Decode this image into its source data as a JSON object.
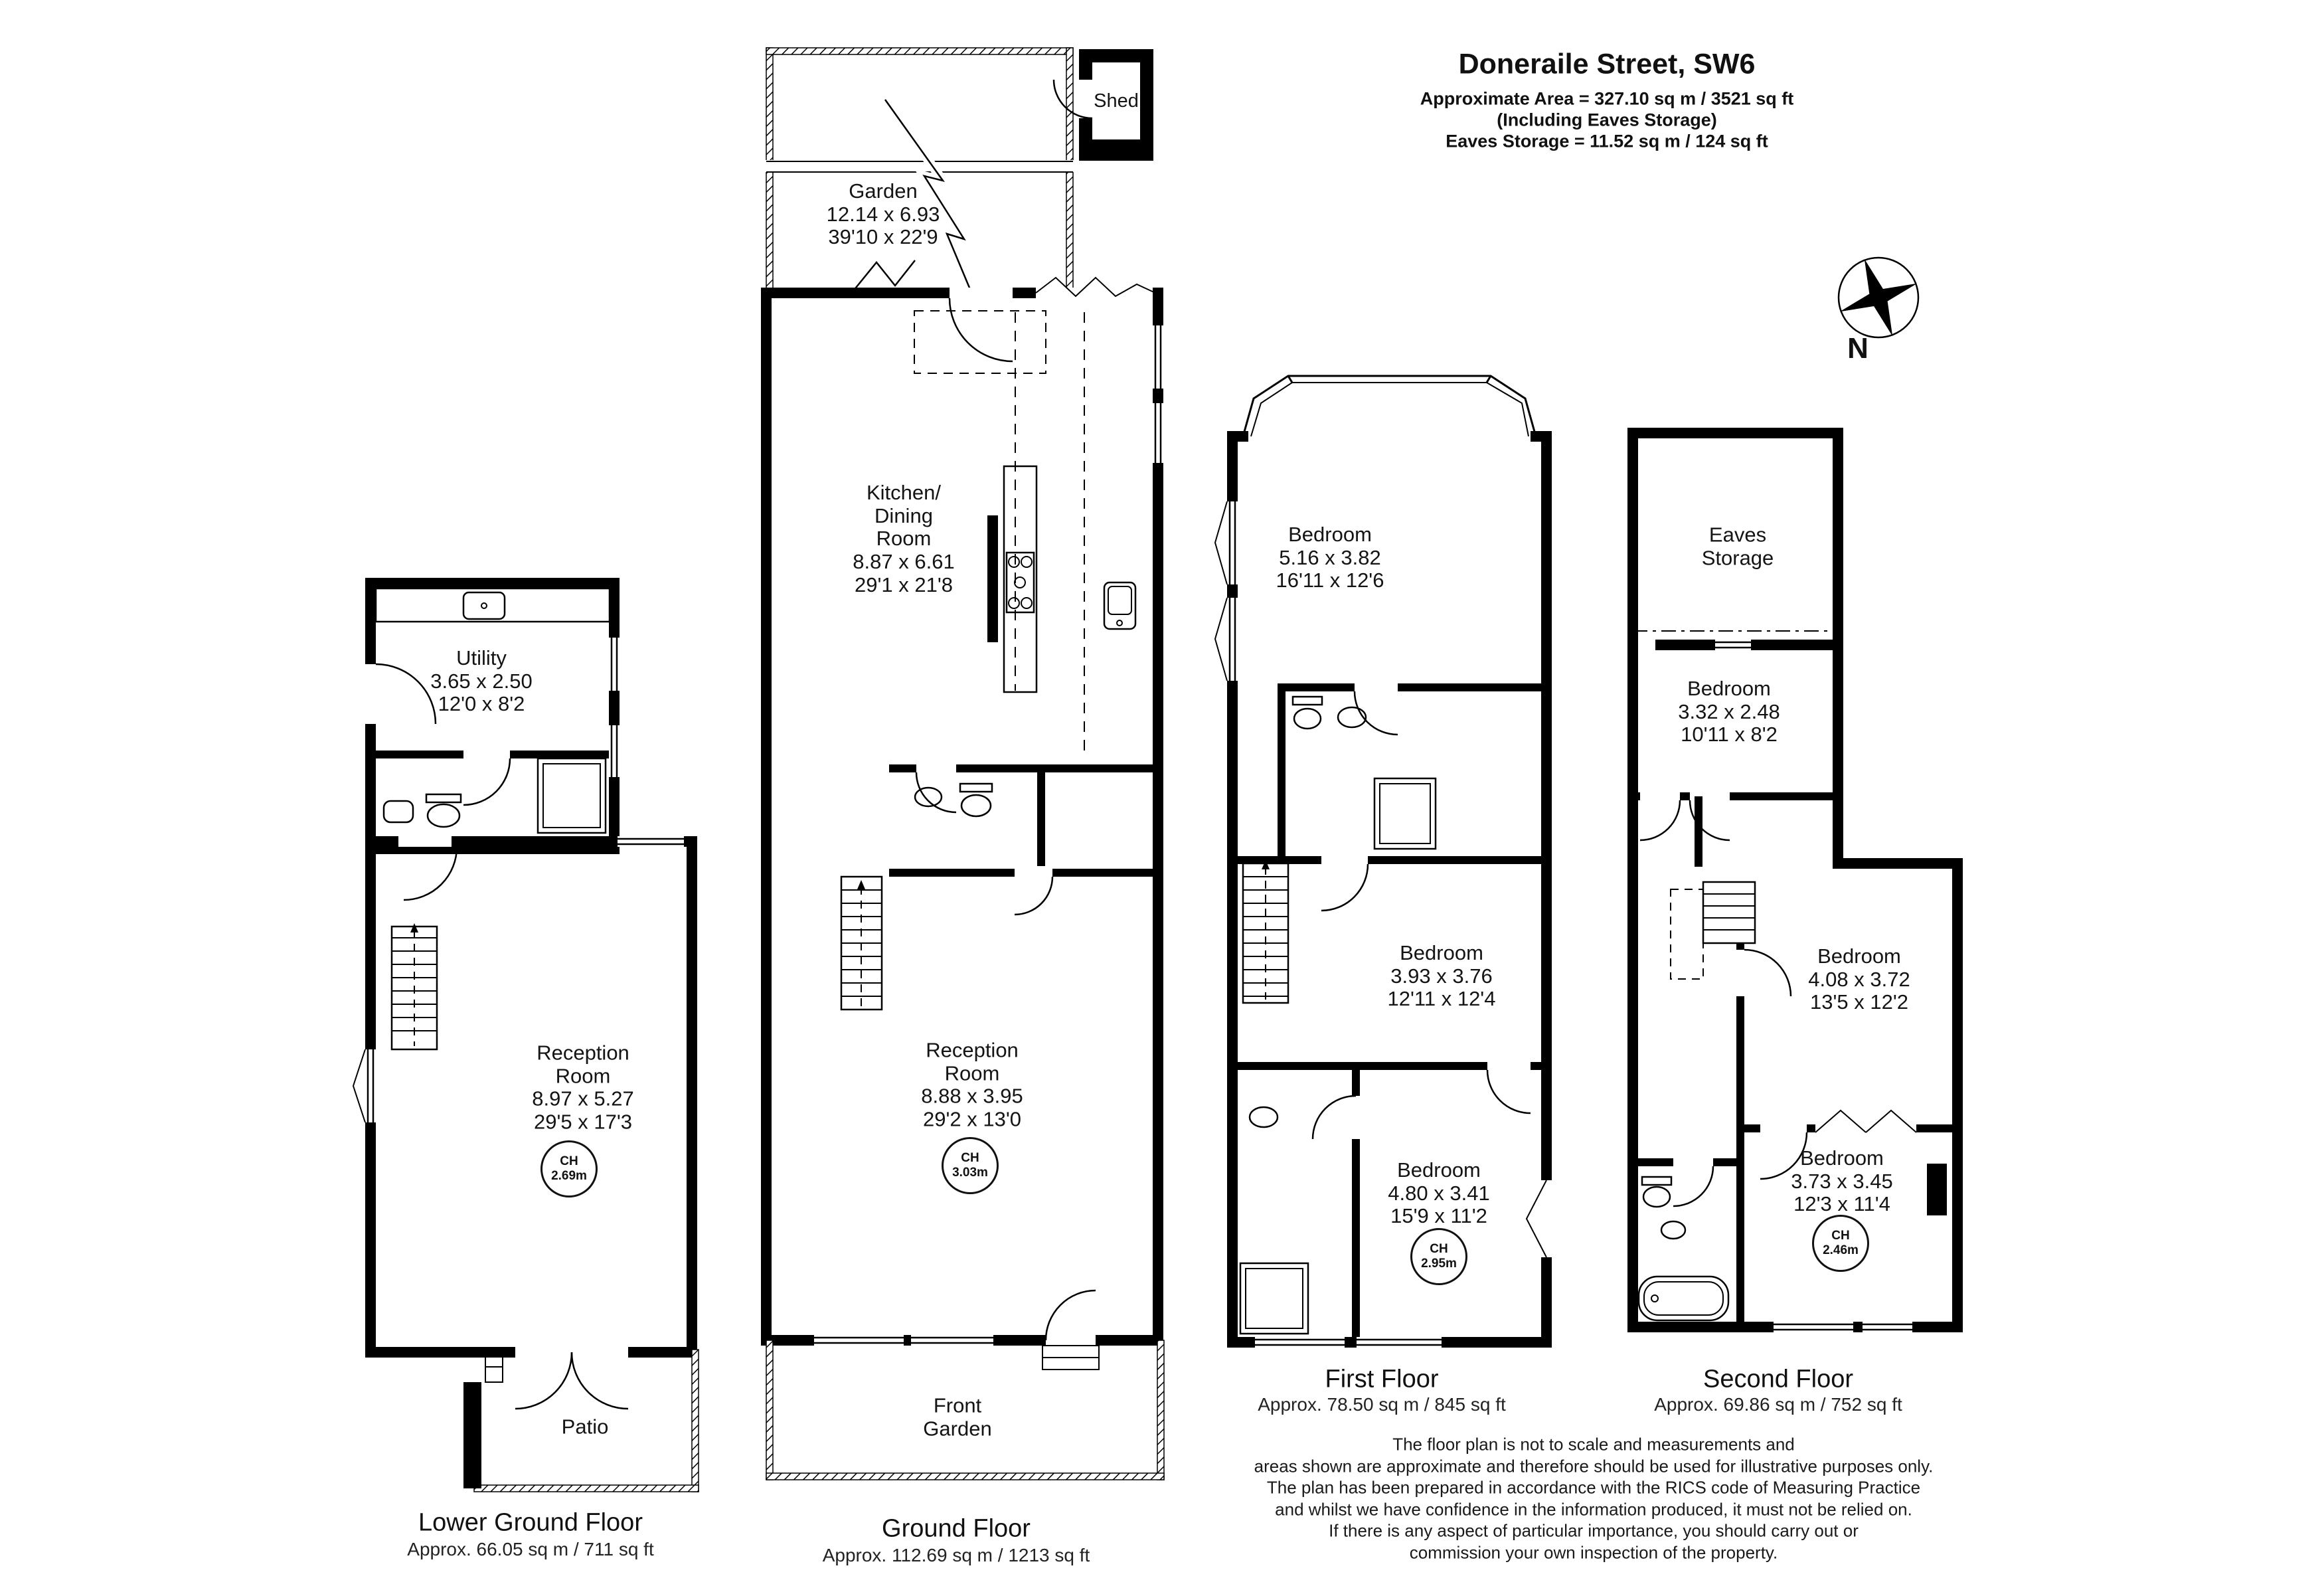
{
  "header": {
    "title": "Doneraile Street, SW6",
    "area_line1": "Approximate Area =  327.10 sq m / 3521 sq ft",
    "area_line2": "(Including Eaves Storage)",
    "area_line3": "Eaves Storage =  11.52 sq m / 124 sq ft"
  },
  "compass": {
    "north_label": "N"
  },
  "floors": [
    {
      "name": "Lower Ground Floor",
      "approx": "Approx. 66.05 sq m / 711 sq ft",
      "rooms": {
        "utility": {
          "label": "Utility\n3.65 x 2.50\n12'0 x 8'2"
        },
        "reception": {
          "label": "Reception\nRoom\n8.97 x 5.27\n29'5 x 17'3",
          "ceiling_height": "CH\n2.69m"
        },
        "patio": {
          "label": "Patio"
        }
      }
    },
    {
      "name": "Ground Floor",
      "approx": "Approx. 112.69 sq m / 1213 sq ft",
      "rooms": {
        "shed": {
          "label": "Shed"
        },
        "garden": {
          "label": "Garden\n12.14 x 6.93\n39'10 x 22'9"
        },
        "kitchen_dining": {
          "label": "Kitchen/\nDining\nRoom\n8.87 x 6.61\n29'1 x 21'8"
        },
        "reception": {
          "label": "Reception\nRoom\n8.88 x 3.95\n29'2 x 13'0",
          "ceiling_height": "CH\n3.03m"
        },
        "front_garden": {
          "label": "Front\nGarden"
        }
      }
    },
    {
      "name": "First Floor",
      "approx": "Approx. 78.50 sq m / 845 sq ft",
      "rooms": {
        "bedroom_front": {
          "label": "Bedroom\n5.16 x 3.82\n16'11 x 12'6"
        },
        "bedroom_middle": {
          "label": "Bedroom\n3.93 x 3.76\n12'11 x 12'4"
        },
        "bedroom_back": {
          "label": "Bedroom\n4.80 x 3.41\n15'9 x 11'2",
          "ceiling_height": "CH\n2.95m"
        }
      }
    },
    {
      "name": "Second Floor",
      "approx": "Approx. 69.86 sq m / 752 sq ft",
      "rooms": {
        "eaves_storage": {
          "label": "Eaves\nStorage"
        },
        "bedroom_small": {
          "label": "Bedroom\n3.32 x 2.48\n10'11 x 8'2"
        },
        "bedroom_middle": {
          "label": "Bedroom\n4.08 x 3.72\n13'5 x 12'2"
        },
        "bedroom_back": {
          "label": "Bedroom\n3.73 x 3.45\n12'3 x 11'4",
          "ceiling_height": "CH\n2.46m"
        }
      }
    }
  ],
  "disclaimer": "The floor plan is not to scale and measurements and\nareas shown are approximate and therefore should be used for illustrative purposes only.\nThe plan has been prepared in accordance with the RICS code of Measuring Practice\nand whilst we have confidence in the information produced, it must not be relied on.\nIf there is any aspect of particular importance, you should carry out or\ncommission your own inspection of the property."
}
